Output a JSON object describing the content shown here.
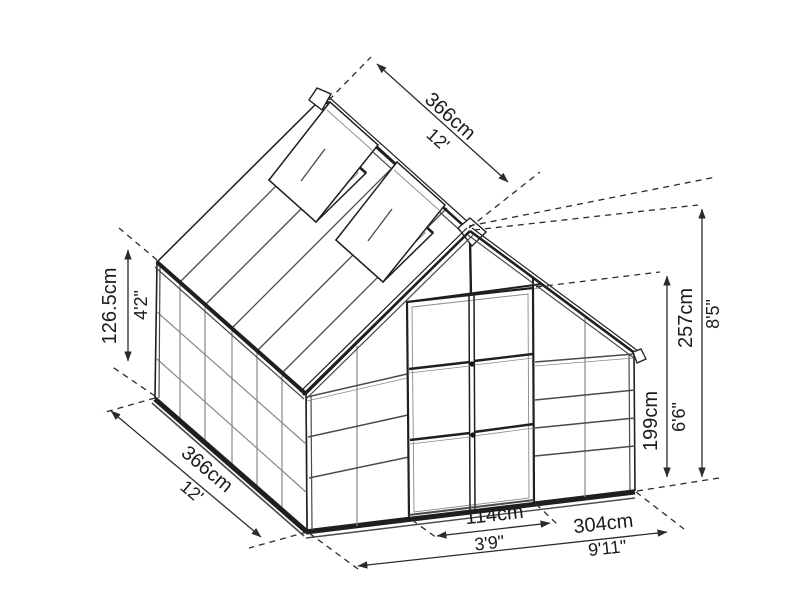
{
  "diagram": {
    "subject": "greenhouse-dimension-drawing",
    "background_color": "#ffffff",
    "line_color": "#1f1f1f",
    "text_color": "#1c1c1c"
  },
  "dimensions": {
    "ridge_length": {
      "metric": "366cm",
      "imperial": "12'"
    },
    "side_length": {
      "metric": "366cm",
      "imperial": "12'"
    },
    "side_wall_height": {
      "metric": "126.5cm",
      "imperial": "4'2\""
    },
    "door_width": {
      "metric": "114cm",
      "imperial": "3'9\""
    },
    "front_width": {
      "metric": "304cm",
      "imperial": "9'11\""
    },
    "door_height": {
      "metric": "199cm",
      "imperial": "6'6\""
    },
    "peak_height": {
      "metric": "257cm",
      "imperial": "8'5\""
    }
  }
}
